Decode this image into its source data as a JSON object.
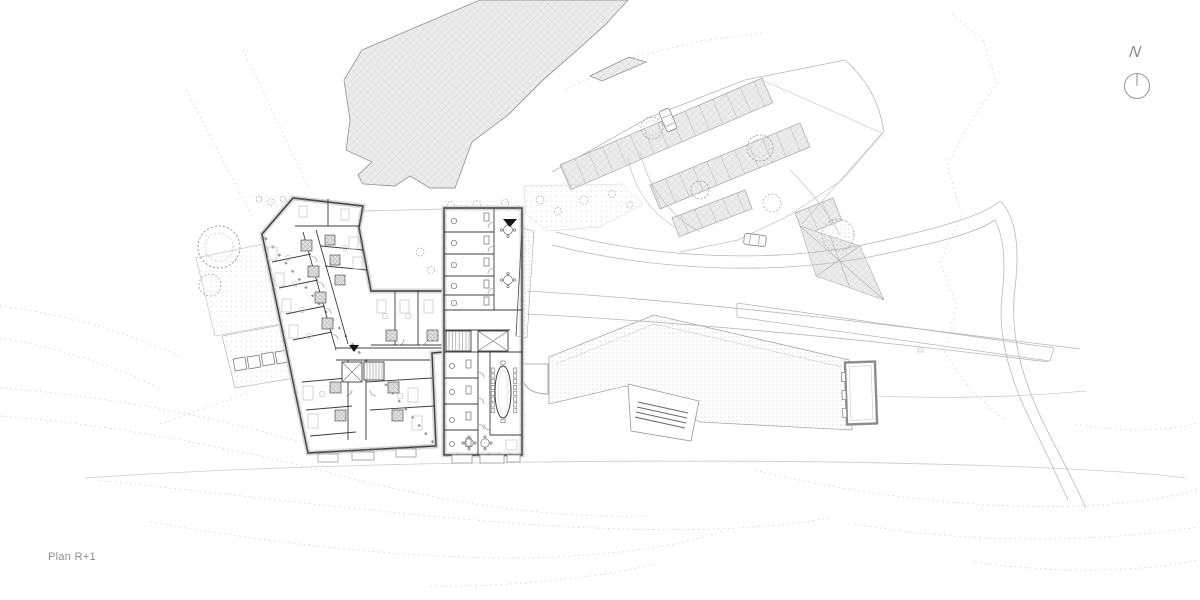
{
  "title_block": {
    "plan_label": "Plan R+1"
  },
  "compass": {
    "north_label": "N"
  },
  "palette": {
    "background": "#ffffff",
    "wall_dark": "#3c3c3c",
    "line_light": "#b8b8b8",
    "line_faint": "#d6d6d6",
    "hatch_fill": "#ececec",
    "hatch_line": "#d0d0d0",
    "bath_hatch_line": "#909090",
    "stipple_dot": "#b6b6b6",
    "contour_gray": "#cfcfcf",
    "marker_black": "#141414",
    "label_gray": "#8c8c8c"
  }
}
